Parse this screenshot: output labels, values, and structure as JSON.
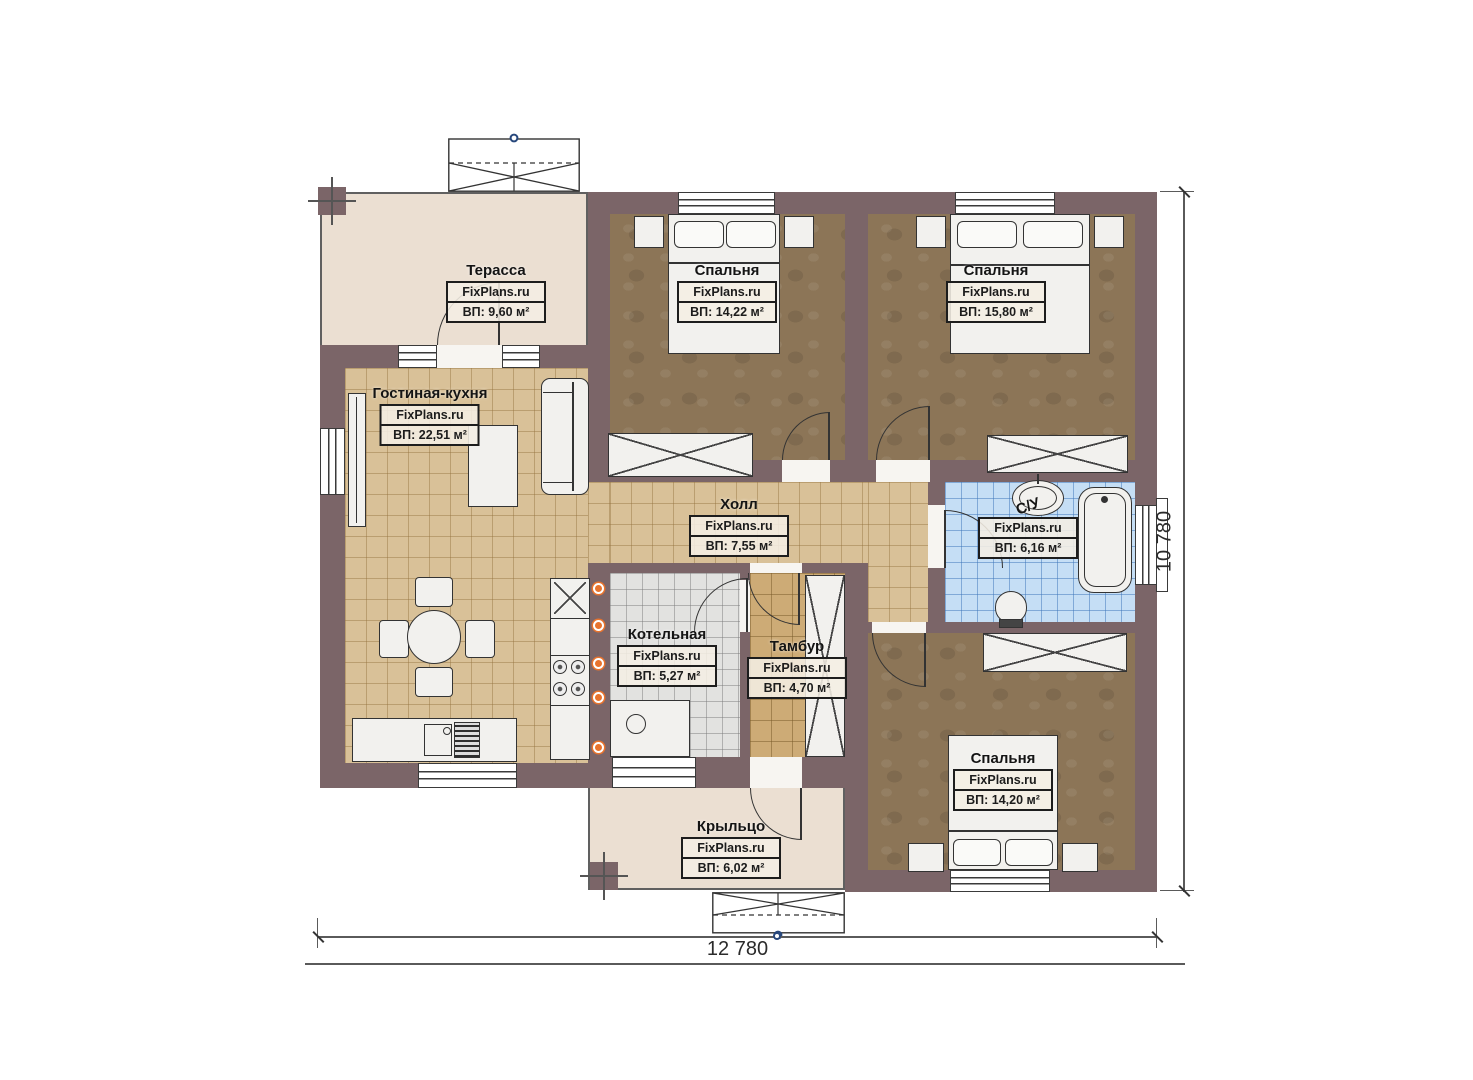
{
  "site_watermark": "FixPlans.ru",
  "plan": {
    "rooms": [
      {
        "key": "terrace",
        "name": "Терасса",
        "area": "ВП: 9,60 м²"
      },
      {
        "key": "bedroom-1",
        "name": "Спальня",
        "area": "ВП: 14,22 м²"
      },
      {
        "key": "bedroom-2",
        "name": "Спальня",
        "area": "ВП: 15,80 м²"
      },
      {
        "key": "living-kitchen",
        "name": "Гостиная-кухня",
        "area": "ВП: 22,51 м²"
      },
      {
        "key": "hall",
        "name": "Холл",
        "area": "ВП: 7,55 м²"
      },
      {
        "key": "bathroom",
        "name": "С/У",
        "area": "ВП: 6,16 м²"
      },
      {
        "key": "boiler-room",
        "name": "Котельная",
        "area": "ВП: 5,27 м²"
      },
      {
        "key": "vestibule",
        "name": "Тамбур",
        "area": "ВП: 4,70 м²"
      },
      {
        "key": "bedroom-3",
        "name": "Спальня",
        "area": "ВП: 14,20 м²"
      },
      {
        "key": "porch",
        "name": "Крыльцо",
        "area": "ВП: 6,02 м²"
      }
    ],
    "dimensions": {
      "width_mm": "12 780",
      "height_mm": "10 780"
    },
    "colors": {
      "wall": "#7b6568",
      "floor_tan": "#d9c198",
      "floor_brown": "#8c7557",
      "floor_blue": "#c5def5",
      "floor_gray": "#e2e2e0",
      "floor_beige": "#ebdfd2",
      "floor_vestibule": "#cdab76",
      "outlet_orange": "#e8732d"
    }
  }
}
